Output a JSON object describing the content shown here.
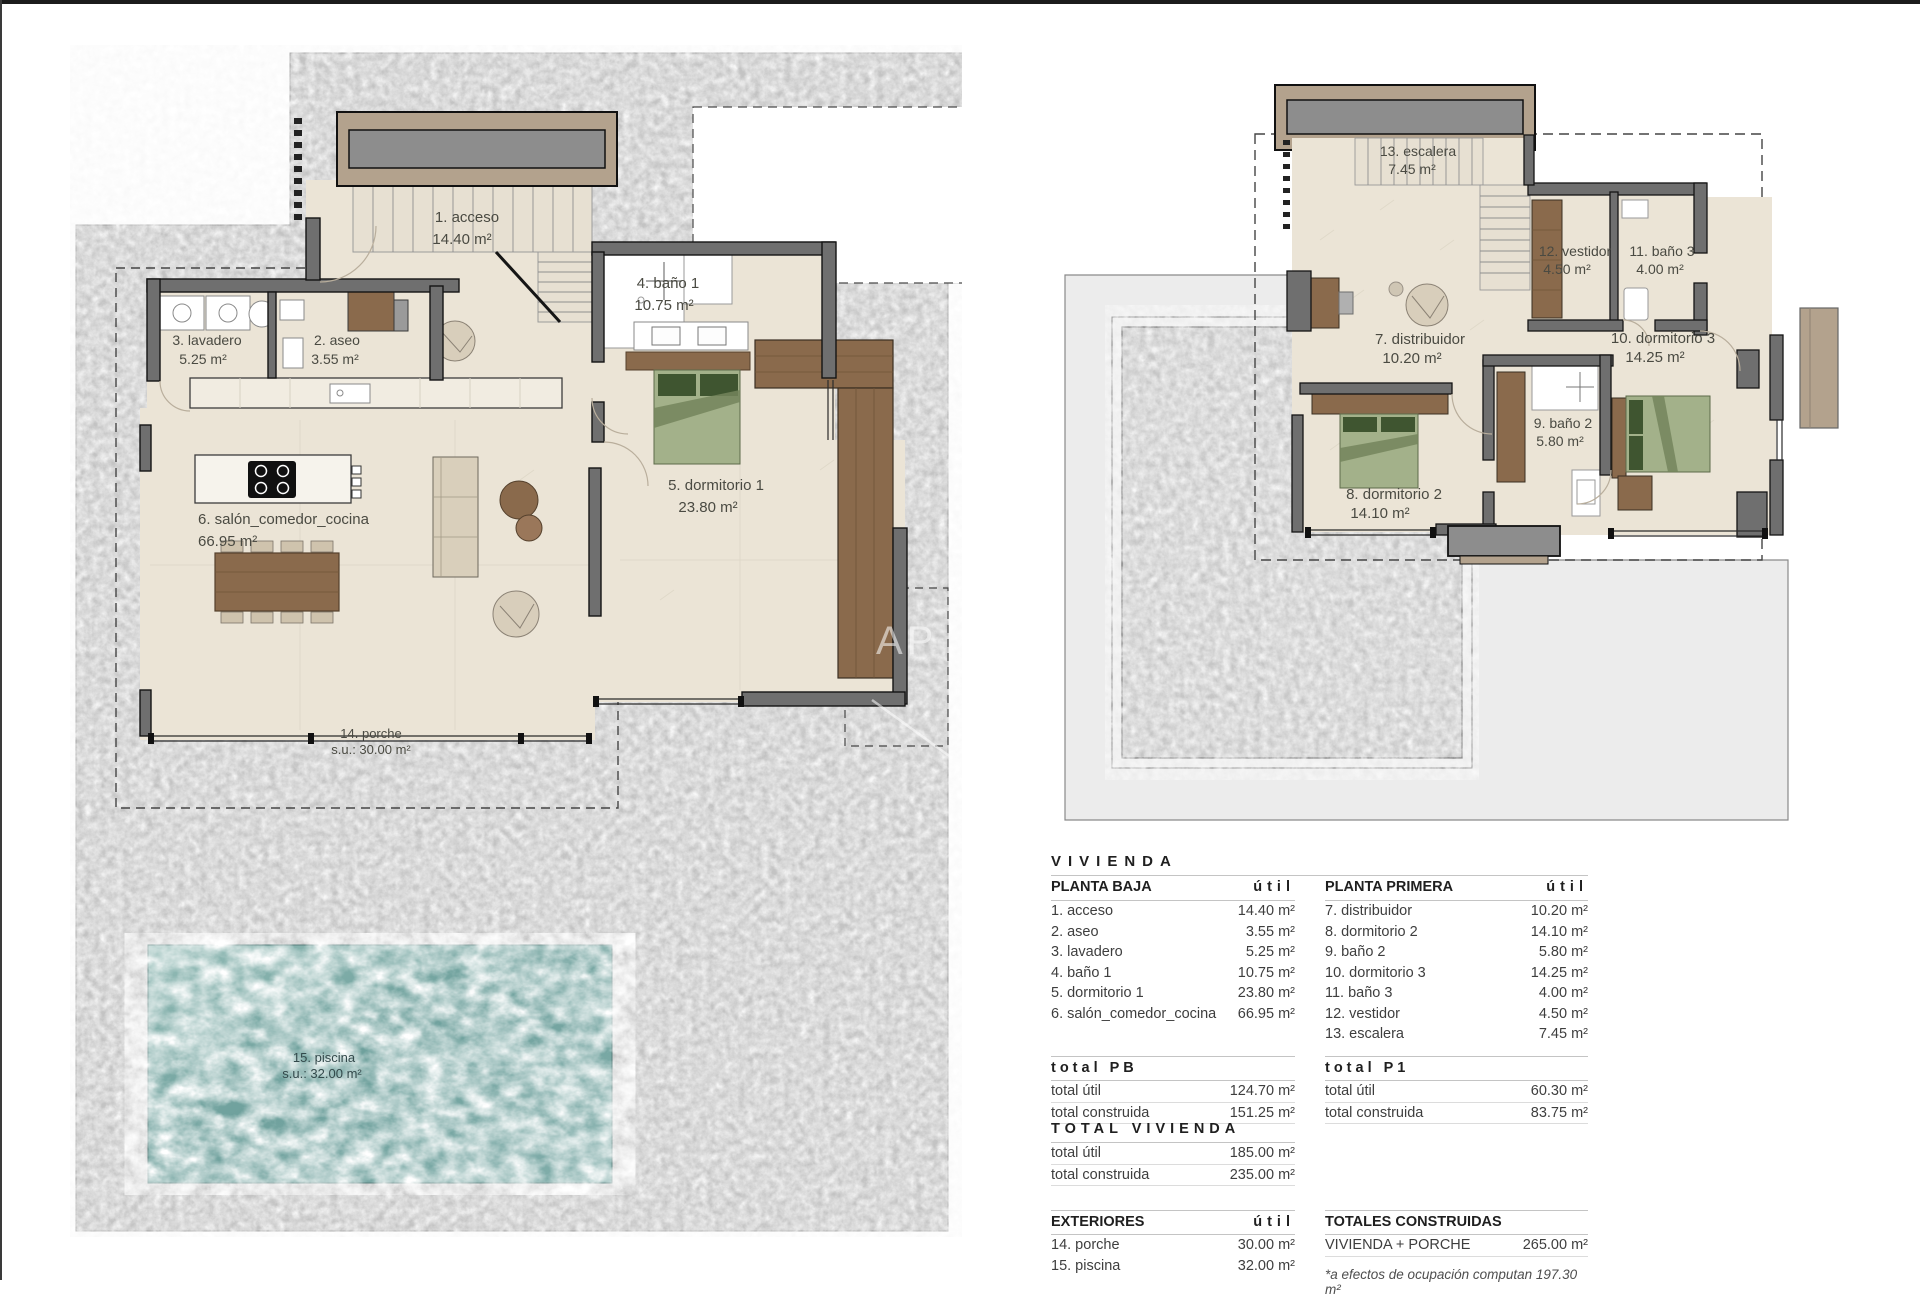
{
  "watermark": "AP",
  "floors": {
    "ground": {
      "rooms": {
        "acceso": {
          "label": "1. acceso",
          "area": "14.40 m²"
        },
        "aseo": {
          "label": "2. aseo",
          "area": "3.55 m²"
        },
        "lavadero": {
          "label": "3. lavadero",
          "area": "5.25 m²"
        },
        "bano1": {
          "label": "4. baño 1",
          "area": "10.75 m²"
        },
        "dormitorio1": {
          "label": "5. dormitorio 1",
          "area": "23.80 m²"
        },
        "salon": {
          "label": "6. salón_comedor_cocina",
          "area": "66.95 m²"
        },
        "porche": {
          "label": "14. porche",
          "area": "s.u.: 30.00 m²"
        },
        "piscina": {
          "label": "15. piscina",
          "area": "s.u.: 32.00 m²"
        }
      }
    },
    "first": {
      "rooms": {
        "distribuidor": {
          "label": "7. distribuidor",
          "area": "10.20 m²"
        },
        "dormitorio2": {
          "label": "8. dormitorio 2",
          "area": "14.10 m²"
        },
        "bano2": {
          "label": "9. baño 2",
          "area": "5.80 m²"
        },
        "dormitorio3": {
          "label": "10. dormitorio 3",
          "area": "14.25 m²"
        },
        "bano3": {
          "label": "11. baño 3",
          "area": "4.00 m²"
        },
        "vestidor": {
          "label": "12. vestidor",
          "area": "4.50 m²"
        },
        "escalera": {
          "label": "13. escalera",
          "area": "7.45 m²"
        }
      }
    }
  },
  "summary": {
    "title": "VIVIENDA",
    "col_util": "útil",
    "planta_baja": {
      "header": "PLANTA BAJA",
      "rows": [
        {
          "label": "1. acceso",
          "value": "14.40 m²"
        },
        {
          "label": "2. aseo",
          "value": "3.55 m²"
        },
        {
          "label": "3. lavadero",
          "value": "5.25 m²"
        },
        {
          "label": "4. baño 1",
          "value": "10.75 m²"
        },
        {
          "label": "5. dormitorio 1",
          "value": "23.80 m²"
        },
        {
          "label": "6. salón_comedor_cocina",
          "value": "66.95 m²"
        }
      ]
    },
    "planta_primera": {
      "header": "PLANTA PRIMERA",
      "rows": [
        {
          "label": "7. distribuidor",
          "value": "10.20 m²"
        },
        {
          "label": "8. dormitorio 2",
          "value": "14.10 m²"
        },
        {
          "label": "9. baño 2",
          "value": "5.80 m²"
        },
        {
          "label": "10. dormitorio 3",
          "value": "14.25 m²"
        },
        {
          "label": "11. baño 3",
          "value": "4.00 m²"
        },
        {
          "label": "12. vestidor",
          "value": "4.50 m²"
        },
        {
          "label": "13. escalera",
          "value": "7.45 m²"
        }
      ]
    },
    "total_pb": {
      "header": "total PB",
      "rows": [
        {
          "label": "total útil",
          "value": "124.70 m²"
        },
        {
          "label": "total construida",
          "value": "151.25 m²"
        }
      ]
    },
    "total_p1": {
      "header": "total P1",
      "rows": [
        {
          "label": "total útil",
          "value": "60.30 m²"
        },
        {
          "label": "total construida",
          "value": "83.75 m²"
        }
      ]
    },
    "total_vivienda": {
      "header": "TOTAL VIVIENDA",
      "rows": [
        {
          "label": "total útil",
          "value": "185.00 m²"
        },
        {
          "label": "total construida",
          "value": "235.00 m²"
        }
      ]
    },
    "exteriores": {
      "header": "EXTERIORES",
      "col_util": "útil",
      "rows": [
        {
          "label": "14. porche",
          "value": "30.00 m²"
        },
        {
          "label": "15. piscina",
          "value": "32.00 m²"
        }
      ]
    },
    "totales_construidas": {
      "header": "TOTALES CONSTRUIDAS",
      "rows": [
        {
          "label": "VIVIENDA + PORCHE",
          "value": "265.00 m²"
        }
      ],
      "note": "*a efectos de ocupación computan 197.30 m²"
    }
  },
  "colors": {
    "terrain": "#c5c5c5",
    "floor": "#ebe4d6",
    "wall": "#6f6f6f",
    "wood": "#8a6a4c",
    "bed": "#a3b18a",
    "pool": "#6fa19d",
    "canopy_trim": "#b3a28d"
  }
}
